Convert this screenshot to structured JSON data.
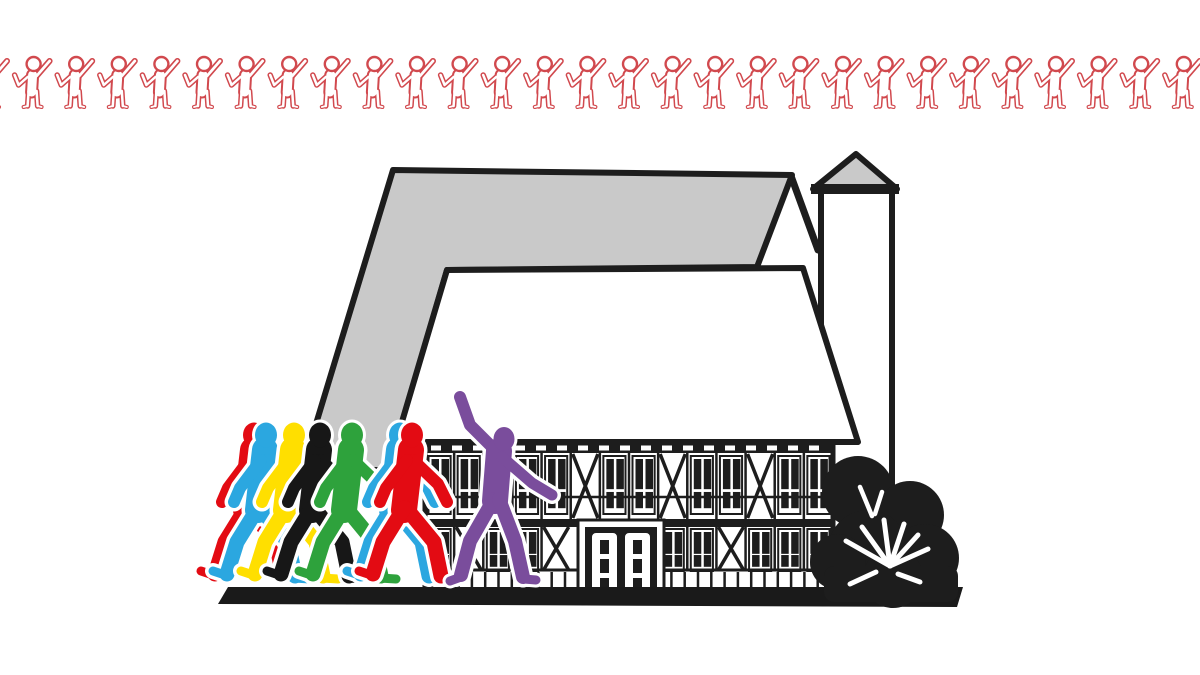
{
  "page": {
    "width": 1200,
    "height": 675,
    "background": "#ffffff"
  },
  "colors": {
    "outline": "#1d1d1d",
    "roof_gray": "#c9c9c9",
    "wall_white": "#ffffff",
    "border_red": "#d1494e",
    "ground_black": "#1a1a1a",
    "bush_black": "#1d1d1d",
    "grass_white": "#ffffff"
  },
  "border_row": {
    "description": "repeating outlined cheering person pictogram",
    "count": 29,
    "spacing": 42.6,
    "start_x": -10,
    "baseline_y": 86,
    "color": "#d1494e"
  },
  "house": {
    "roof_color": "#c9c9c9",
    "facade": {
      "upper_cells": [
        "w",
        "w",
        "x",
        "w",
        "w",
        "x",
        "w",
        "w",
        "x",
        "w",
        "w",
        "x",
        "w",
        "w"
      ],
      "lower_cells": [
        "w",
        "x",
        "w",
        "w",
        "x",
        "D",
        "D",
        "D",
        "w",
        "w",
        "x",
        "w",
        "w",
        "w"
      ],
      "left": 425,
      "right": 833,
      "top": 443,
      "bottom": 600
    },
    "door": {
      "leaves": 2,
      "lites_per_leaf": 3
    }
  },
  "walkers": {
    "y": 422,
    "figures": [
      {
        "name": "walker-red-back",
        "color": "#e30b13",
        "x": 192
      },
      {
        "name": "walker-blue-left",
        "color": "#2ba7e0",
        "x": 204
      },
      {
        "name": "walker-yellow",
        "color": "#ffdf00",
        "x": 232
      },
      {
        "name": "walker-black",
        "color": "#171717",
        "x": 258
      },
      {
        "name": "walker-green",
        "color": "#2ea23c",
        "x": 290
      },
      {
        "name": "walker-blue-right",
        "color": "#2ba7e0",
        "x": 338
      },
      {
        "name": "walker-red-front",
        "color": "#e30b13",
        "x": 350
      }
    ]
  },
  "waver": {
    "name": "waving-person",
    "color": "#7a4d9c",
    "x": 450,
    "y": 395
  }
}
